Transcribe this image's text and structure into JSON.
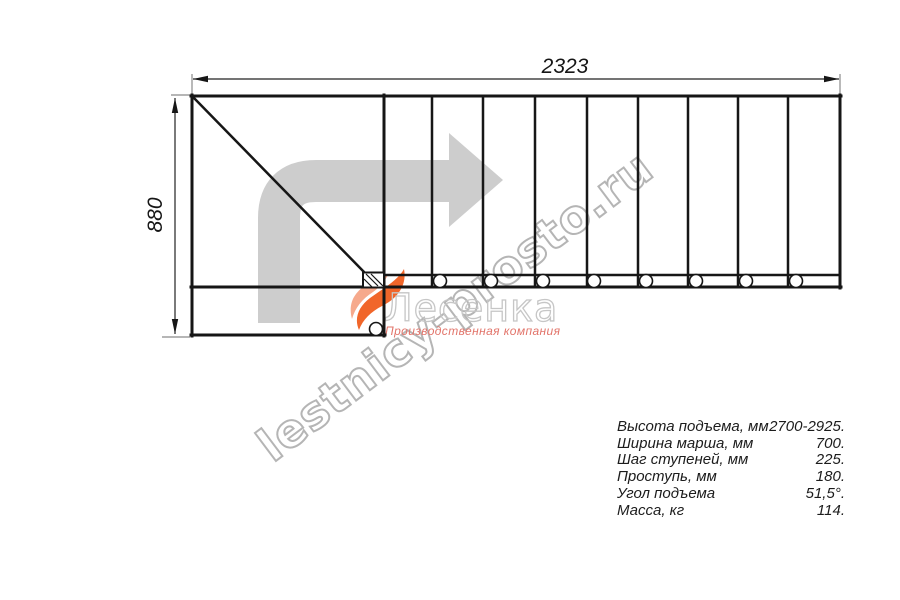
{
  "drawing": {
    "width_dim": "2323",
    "height_dim": "880",
    "treads": 9,
    "mounting_holes": 8
  },
  "watermark": {
    "site": "lestnicy-prosto.ru",
    "brand": "Лесенка",
    "tagline": "Производственная компания"
  },
  "specs": {
    "rows": [
      {
        "label": "Высота подъема, мм",
        "value": "2700-2925."
      },
      {
        "label": "Ширина марша, мм",
        "value": "700."
      },
      {
        "label": "Шаг ступеней, мм",
        "value": "225."
      },
      {
        "label": "Проступь, мм",
        "value": "180."
      },
      {
        "label": "Угол подъема",
        "value": "51,5°."
      },
      {
        "label": "Масса, кг",
        "value": "114."
      }
    ]
  },
  "colors": {
    "line_black": "#161616",
    "dimension_gray": "#8a8a8a",
    "arrow_gray": "#cdcdcd",
    "watermark_gray": "#b5b5b5",
    "brand_gray": "#c6c6c6",
    "flame_orange": "#f1662a",
    "flame_salmon": "#f6a98c",
    "tagline_red": "#e2746a"
  }
}
